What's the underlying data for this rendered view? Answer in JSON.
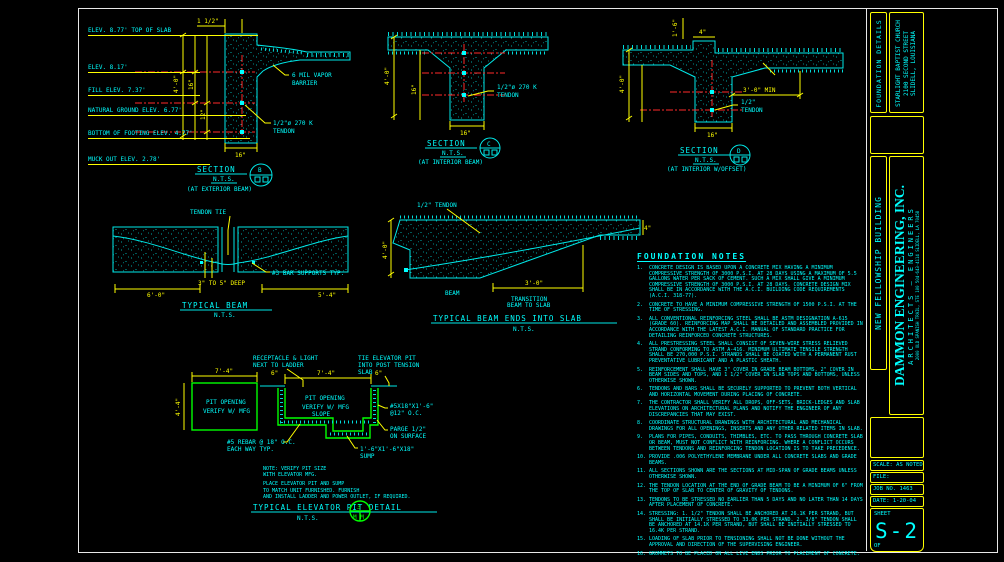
{
  "sheet_title": "FOUNDATION DETAILS",
  "sections": {
    "exterior": {
      "name": "SECTION",
      "scale": "N.T.S.",
      "location": "(AT EXTERIOR BEAM)",
      "bubble": "B",
      "dim_top": "1 1/2\"",
      "dim_height": "4'-0\"",
      "dim_h1": "16\"",
      "dim_h2": "12\"",
      "dim_width": "16\"",
      "vapor1": "6 MIL VAPOR",
      "vapor2": "BARRIER",
      "tendon1": "1/2\"ø 270 K",
      "tendon2": "TENDON"
    },
    "interior": {
      "name": "SECTION",
      "scale": "N.T.S.",
      "location": "(AT INTERIOR BEAM)",
      "bubble": "C",
      "dim_height": "4'-0\"",
      "dim_h1": "16\"",
      "dim_width": "16\"",
      "tendon1": "1/2\"ø 270 K",
      "tendon2": "TENDON"
    },
    "offset": {
      "name": "SECTION",
      "scale": "N.T.S.",
      "location": "(AT INTERIOR W/OFFSET)",
      "bubble": "D",
      "dim_drop": "1'-6\"",
      "dim_curb": "4\"",
      "dim_height": "4'-0\"",
      "dim_min": "3'-0\" MIN",
      "dim_width": "16\"",
      "tendon1": "1/2\"",
      "tendon2": "TENDON"
    }
  },
  "elevations": [
    "ELEV. 8.77' TOP OF SLAB",
    "ELEV. 8.17'",
    "FILL ELEV. 7.37'",
    "NATURAL GROUND ELEV. 6.77'",
    "BOTTOM OF FOOTING ELEV. 4.77'",
    "MUCK OUT ELEV. 2.78'"
  ],
  "typical_beam": {
    "title": "TYPICAL BEAM",
    "scale": "N.T.S.",
    "tendon_tie": "TENDON TIE",
    "bar_supports": "#3 BAR SUPPORTS TYP.",
    "depth": "3\" TO 5\" DEEP",
    "dim_left": "6'-0\"",
    "dim_right": "5'-4\""
  },
  "beam_into_slab": {
    "title": "TYPICAL BEAM ENDS INTO SLAB",
    "scale": "N.T.S.",
    "tendon": "1/2\" TENDON",
    "beam": "BEAM",
    "trans1": "TRANSITION",
    "trans2": "BEAM TO SLAB",
    "dim": "3'-0\"",
    "dim_height": "4'-0\"",
    "dim_edge": "4\""
  },
  "elevator_pit": {
    "plan": {
      "dim_w": "7'-4\"",
      "dim_h": "4'-4\"",
      "open1": "PIT OPENING",
      "open2": "VERIFY W/ MFG"
    },
    "section": {
      "dim_w": "7'-4\"",
      "off1": "6\"",
      "off2": "6\"",
      "open1": "PIT OPENING",
      "open2": "VERIFY W/ MFG",
      "slope": "SLOPE"
    },
    "labels": {
      "recep1": "RECEPTACLE & LIGHT",
      "recep2": "NEXT TO LADDER",
      "tie1": "TIE ELEVATOR PIT",
      "tie2": "INTO POST TENSION",
      "tie3": "SLAB",
      "bars1": "#5X18\"X1'-6\"",
      "bars2": "@12\" O.C.",
      "parge1": "PARGE 1/2\"",
      "parge2": "ON SURFACE",
      "rebar1": "#5 REBAR @ 18\" O.C.",
      "rebar2": "EACH WAY TYP.",
      "sump1": "1'-6\"X1'-6\"X18\"",
      "sump2": "SUMP"
    },
    "note_lines": [
      "NOTE: VERIFY PIT SIZE",
      "WITH ELEVATOR MFG.",
      "PLACE ELEVATOR PIT AND SUMP",
      "TO MATCH UNIT FURNISHED.  FURNISH",
      "AND INSTALL LADDER AND POWER OUTLET, IF REQUIRED."
    ],
    "title": "TYPICAL ELEVATOR PIT DETAIL",
    "scale": "N.T.S.",
    "bubble_top": "3",
    "bubble_bottom": "M M"
  },
  "notes": {
    "title": "FOUNDATION NOTES",
    "items": [
      {
        "num": "1.",
        "text": "CONCRETE DESIGN IS BASED UPON A CONCRETE MIX HAVING A MINIMUM COMPRESSIVE STRENGTH OF 3000 P.S.I. AT 28 DAYS USING A MAXIMUM OF 5.5 GALLONS WATER PER SACK OF CEMENT. SUCH A MIX SHALL GIVE A MINIMUM COMPRESSIVE STRENGTH OF 3000 P.S.I. AT 28 DAYS. CONCRETE DESIGN MIX SHALL BE IN ACCORDANCE WITH THE A.C.I. BUILDING CODE REQUIREMENTS (A.C.I. 318-77)."
      },
      {
        "num": "2.",
        "text": "CONCRETE TO HAVE A MINIMUM COMPRESSIVE STRENGTH OF 1500 P.S.I. AT THE TIME OF STRESSING."
      },
      {
        "num": "3.",
        "text": "ALL CONVENTIONAL REINFORCING STEEL SHALL BE ASTM DESIGNATION A-615 (GRADE 60). REINFORCING MAP SHALL BE DETAILED AND ASSEMBLED PROVIDED IN ACCORDANCE WITH THE LATEST A.C.I. MANUAL OF STANDARD PRACTICE FOR DETAILING REINFORCED CONCRETE STRUCTURES."
      },
      {
        "num": "4.",
        "text": "ALL PRESTRESSING STEEL SHALL CONSIST OF SEVEN-WIRE STRESS RELIEVED STRAND CONFORMING TO ASTM A-416.  MINIMUM ULTIMATE TENSILE STRENGTH SHALL BE 270,000 P.S.I. STRANDS SHALL BE COATED WITH A PERMANENT RUST PREVENTATIVE LUBRICANT AND A PLASTIC SHEATH."
      },
      {
        "num": "5.",
        "text": "REINFORCEMENT SHALL HAVE 3\" COVER IN GRADE BEAM BOTTOMS, 2\" COVER IN BEAM SIDES AND TOPS, AND 1 1/2\" COVER IN SLAB TOPS AND BOTTOMS, UNLESS OTHERWISE SHOWN."
      },
      {
        "num": "6.",
        "text": "TENDONS AND BARS SHALL BE SECURELY SUPPORTED TO PREVENT BOTH VERTICAL AND HORIZONTAL MOVEMENT DURING PLACING OF CONCRETE."
      },
      {
        "num": "7.",
        "text": "THE CONTRACTOR SHALL VERIFY ALL DROPS, OFF-SETS, BRICK-LEDGES AND SLAB ELEVATIONS ON ARCHITECTURAL PLANS AND NOTIFY THE ENGINEER OF ANY DISCREPANCIES THAT MAY EXIST."
      },
      {
        "num": "8.",
        "text": "COORDINATE STRUCTURAL DRAWINGS WITH ARCHITECTURAL AND MECHANICAL DRAWINGS FOR ALL OPENINGS, INSERTS AND ANY OTHER RELATED ITEMS IN SLAB."
      },
      {
        "num": "9.",
        "text": "PLANS FOR PIPES, CONDUITS, THIMBLES, ETC. TO PASS THROUGH CONCRETE SLAB OR BEAM, MUST NOT CONFLICT WITH REINFORCING.  WHERE A CONFLICT OCCURS BETWEEN TENDONS AND REINFORCING TENDON LOCATION IS TO TAKE PRECEDENCE."
      },
      {
        "num": "10.",
        "text": "PROVIDE .006 POLYETHYLENE MEMBRANE UNDER ALL CONCRETE SLABS AND GRADE BEAMS."
      },
      {
        "num": "11.",
        "text": "ALL SECTIONS SHOWN ARE THE SECTIONS AT MID-SPAN OF GRADE BEAMS UNLESS OTHERWISE SHOWN."
      },
      {
        "num": "12.",
        "text": "THE TENDON LOCATION AT THE END OF GRADE BEAM TO BE A MINIMUM OF 6\" FROM THE TOP OF SLAB TO CENTER OF GRAVITY OF TENDONS."
      },
      {
        "num": "13.",
        "text": "TENDONS TO BE STRESSED NO EARLIER THAN 5 DAYS AND NO LATER THAN 14 DAYS AFTER PLACEMENT OF CONCRETE."
      },
      {
        "num": "14.",
        "text": "STRESSING:  1. 1/2\" TENDON SHALL BE ANCHORED AT 26.1K PER STRAND, BUT SHALL BE INITIALLY STRESSED TO 33.0K PER STRAND.  2. 3/8\" TENDON SHALL BE ANCHORED AT 14.1K PER STRAND, BUT SHALL BE INITIALLY STRESSED TO 16.4K PER STRAND."
      },
      {
        "num": "15.",
        "text": "LOADING OF SLAB PRIOR TO TENSIONING SHALL NOT BE DONE WITHOUT THE APPROVAL AND DIRECTION OF THE SUPERVISING ENGINEER."
      },
      {
        "num": "16.",
        "text": "GROMMETS TO BE PLACED ON ALL LIVE ENDS PRIOR TO PLACEMENT OF CONCRETE."
      }
    ]
  },
  "titleblock": {
    "project_type": "FOUNDATION DETAILS",
    "client": "STARLIGHT BAPTIST CHURCH",
    "address1": "2100 SECOND STREET",
    "address2": "SLIDELL, LOUISIANA",
    "building": "NEW FELLOWSHIP BUILDING",
    "firm_name": "DAMMON ENGINEERING, INC.",
    "firm_sub": "ARCHITECTS — ENGINEERS",
    "firm_addr": "2000 OLD SPANISH TRAIL, STE 100   504-643-4114   SLIDELL, LA 70458",
    "rows": [
      {
        "label": "SCALE:",
        "value": "AS NOTED"
      },
      {
        "label": "FILE:",
        "value": ""
      },
      {
        "label": "JOB NO.",
        "value": "1463"
      },
      {
        "label": "DATE:",
        "value": "1-20-04"
      }
    ],
    "sheet_label": "SHEET",
    "sheet_no": "S-2",
    "of_label": "OF"
  }
}
